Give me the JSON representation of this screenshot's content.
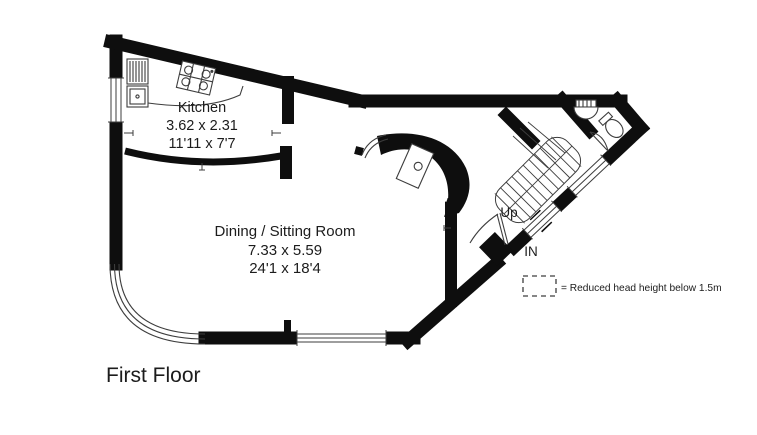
{
  "title": {
    "floor_label": "First Floor"
  },
  "rooms": {
    "kitchen": {
      "name": "Kitchen",
      "metric": "3.62 x 2.31",
      "imperial": "11'11 x 7'7"
    },
    "dining": {
      "name": "Dining / Sitting Room",
      "metric": "7.33 x 5.59",
      "imperial": "24'1 x 18'4"
    }
  },
  "annotations": {
    "up": "Up",
    "entrance": "IN"
  },
  "legend": {
    "label": "= Reduced head height below 1.5m"
  },
  "colors": {
    "wall": "#0e0e0e",
    "line": "#3d3d3d",
    "text": "#1c1c1c",
    "background": "#ffffff"
  }
}
